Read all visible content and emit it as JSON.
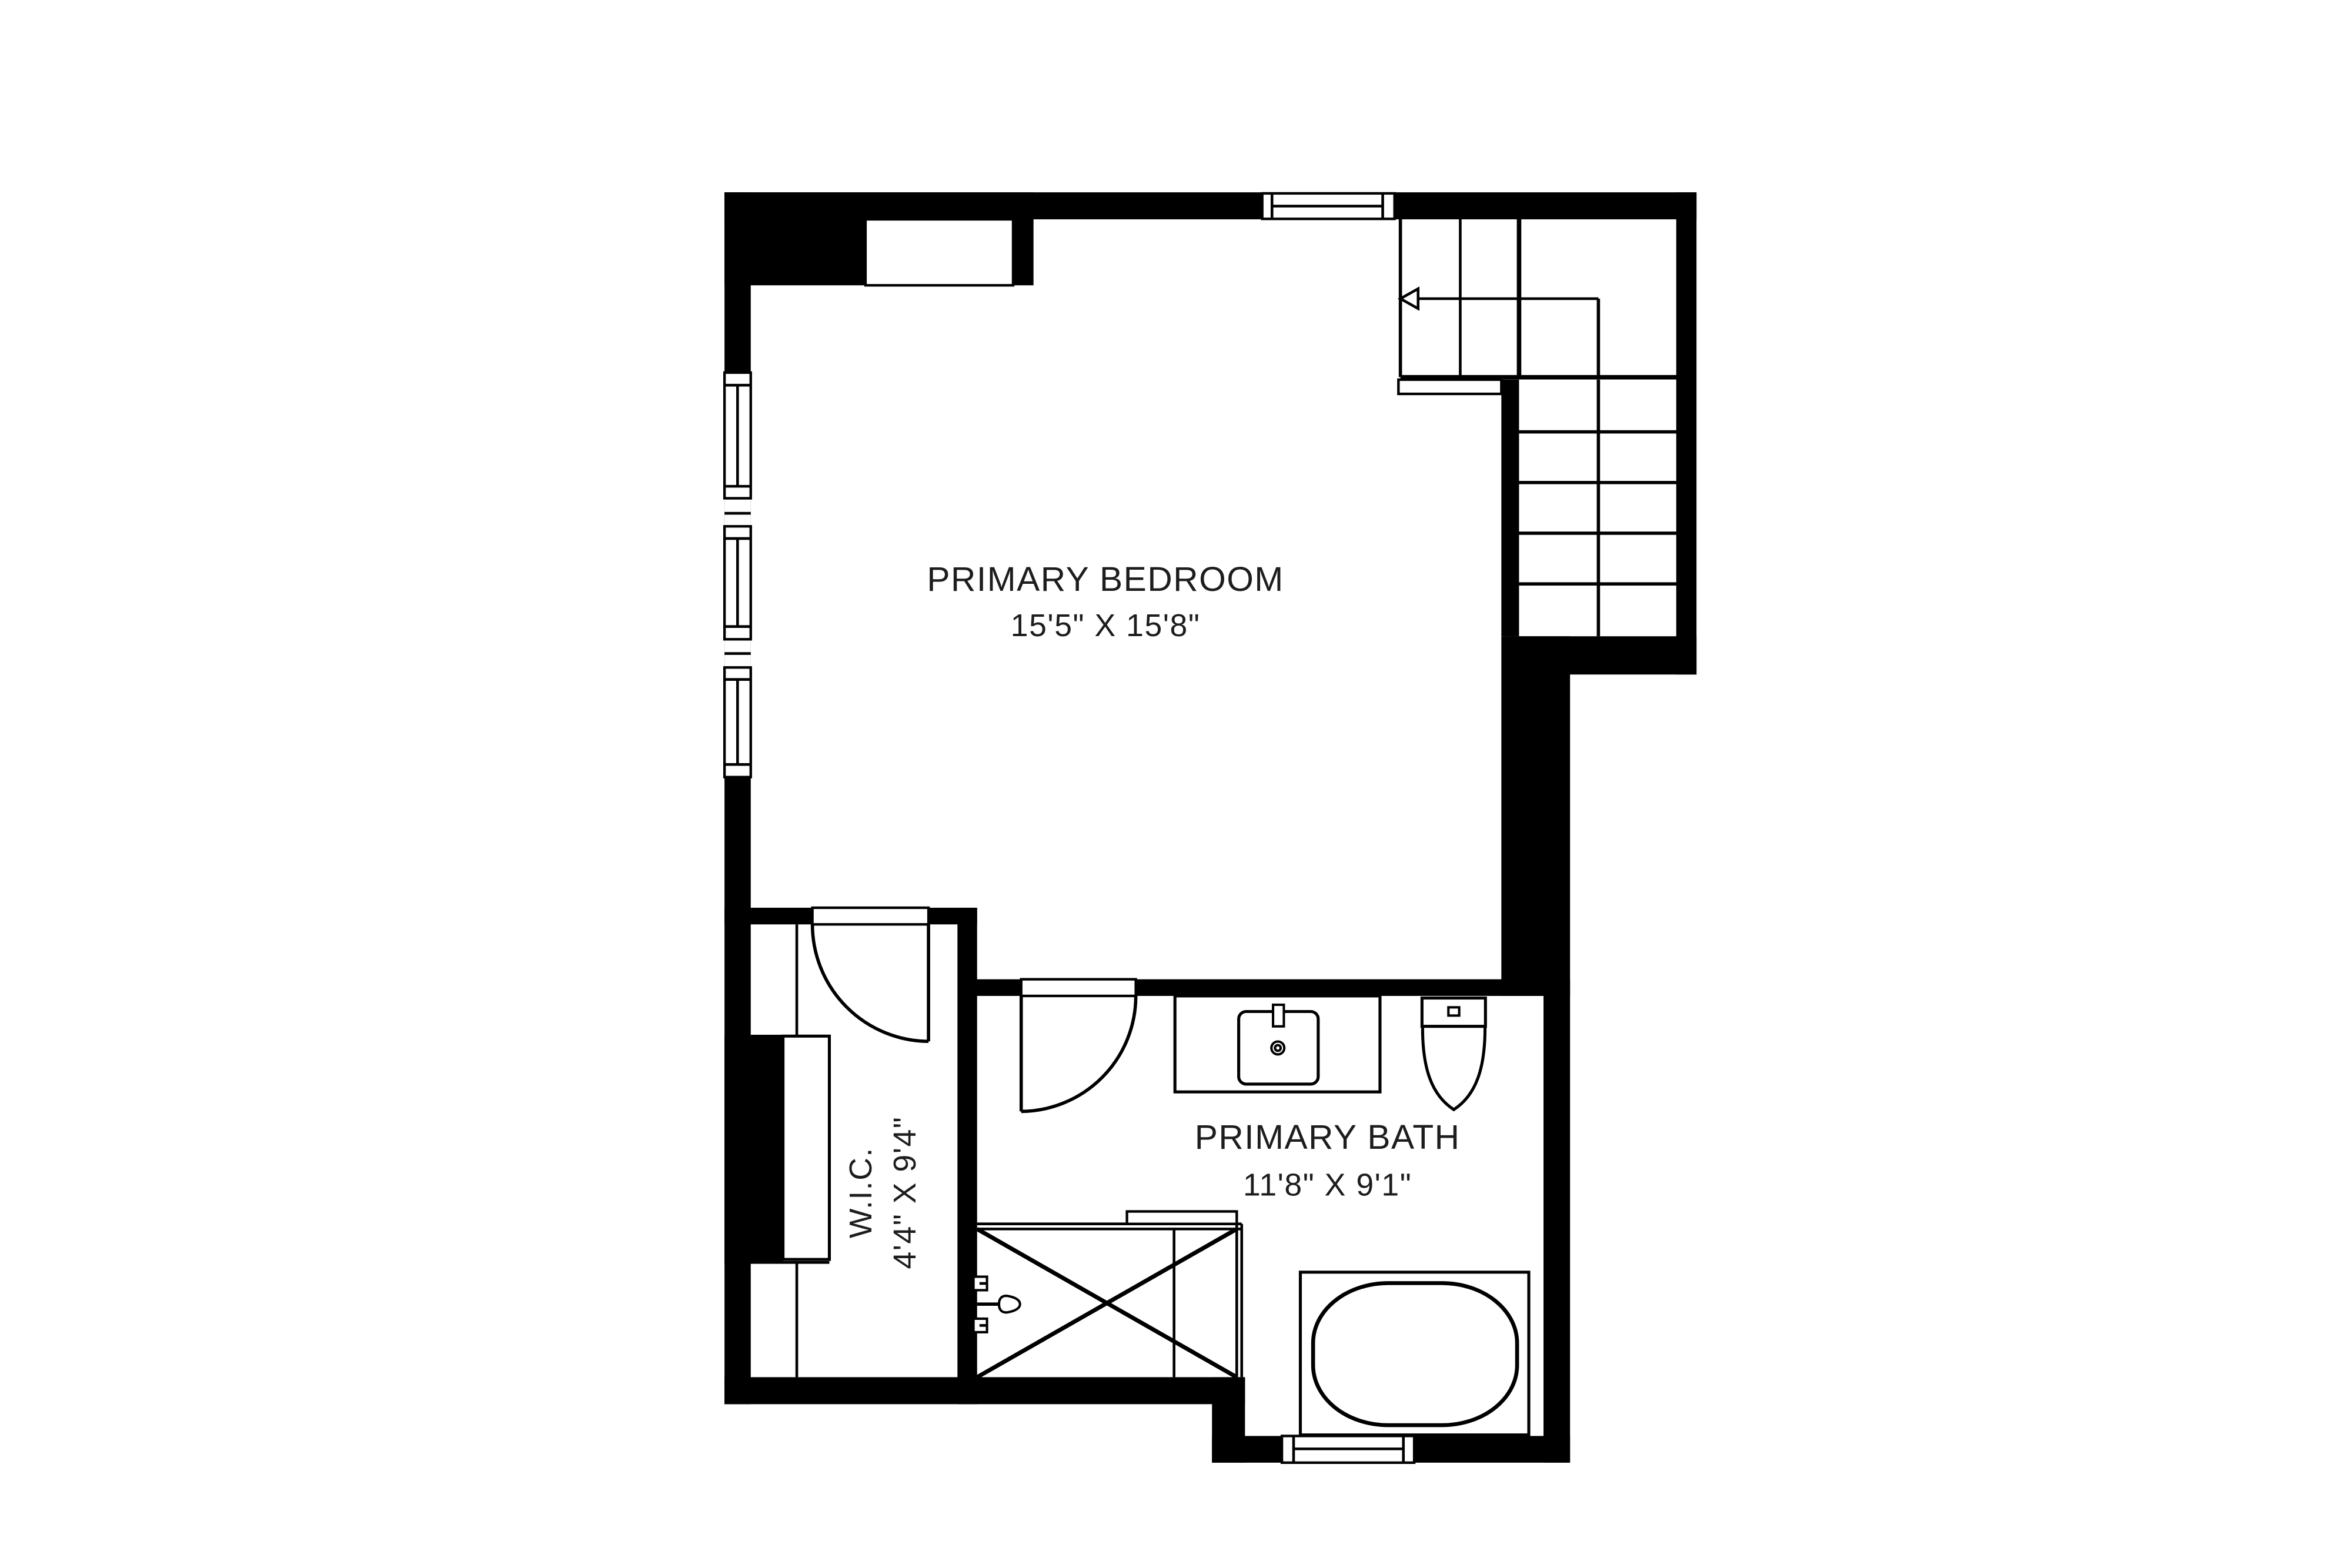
{
  "plan": {
    "title": "Primary suite floor plan",
    "colors": {
      "background": "#ffffff",
      "walls": "#000000",
      "lines": "#000000",
      "text": "#1d1d1d"
    },
    "rooms": [
      {
        "id": "primary-bedroom",
        "name": "PRIMARY BEDROOM",
        "dimensions": "15'5\" X 15'8\""
      },
      {
        "id": "primary-bath",
        "name": "PRIMARY BATH",
        "dimensions": "11'8\" X 9'1\""
      },
      {
        "id": "wic",
        "name": "W.I.C.",
        "dimensions": "4'4\" X 9'4\""
      }
    ],
    "stairs": {
      "upper_flight_treads": 4,
      "lower_flight_rows": 5,
      "lower_flight_columns": 2,
      "direction_arrow": "left"
    },
    "windows_count": 5,
    "doors_count": 2,
    "fixtures": [
      "stairs",
      "vanity-sink",
      "toilet",
      "bathtub",
      "shower",
      "wardrobe",
      "shower-valve"
    ]
  }
}
